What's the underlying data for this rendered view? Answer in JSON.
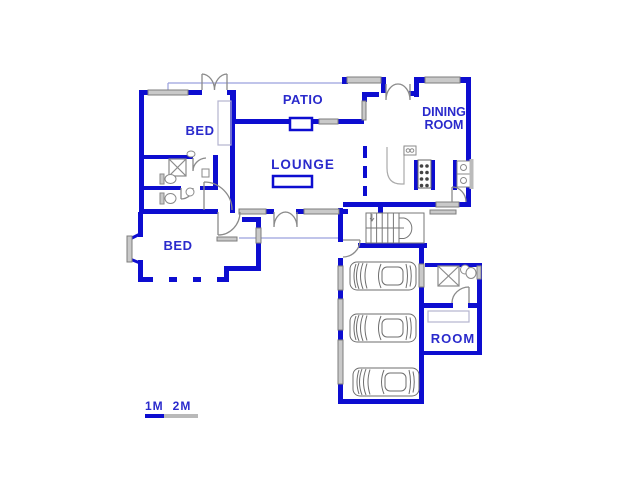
{
  "floorplan": {
    "labels": {
      "patio": "PATIO",
      "dining_line1": "DINING",
      "dining_line2": "ROOM",
      "bedroom_top": "BED",
      "lounge": "LOUNGE",
      "bedroom_bottom": "BED",
      "staff_room": "ROOM"
    },
    "scale": {
      "label_1m": "1M",
      "label_2m": "2M"
    },
    "garage": {
      "car_count": 3
    },
    "colors": {
      "wall": "#0d0dd0",
      "label_text": "#2a2acc",
      "window_fill": "#c9c9c9",
      "window_edge": "#7d7d7d",
      "fixture": "#8a8a8a",
      "thin_line": "#9aa0dd"
    }
  }
}
